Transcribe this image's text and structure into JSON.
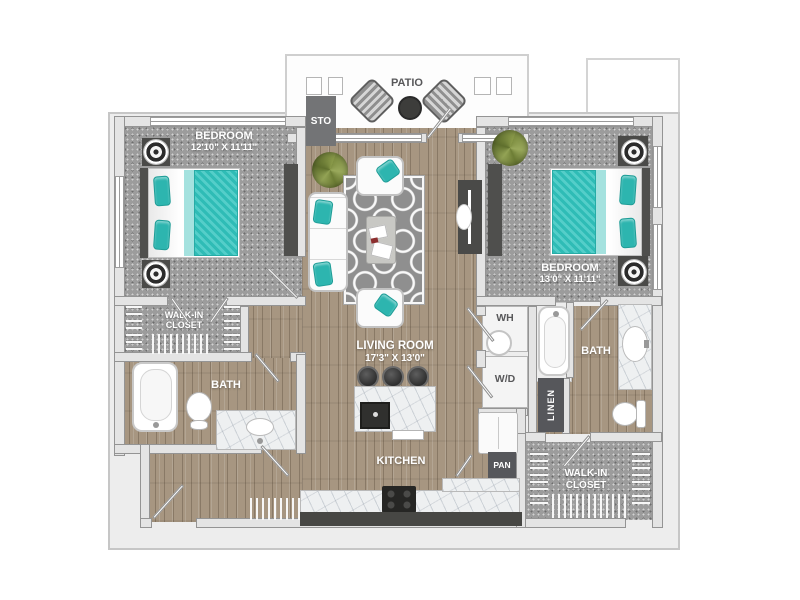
{
  "palette": {
    "teal": "#3fc4be",
    "wood": "#a79681",
    "carpet": "#9c9c9c",
    "wall": "#e4e4e4",
    "dark_furniture": "#4a4a48",
    "dark_box": "#56575b",
    "label_gray": "#58585a",
    "marble": "#eef0f1",
    "plant_green": "#8a9a4a"
  },
  "rooms": {
    "bedroom_left": {
      "label": "BEDROOM",
      "dims": "12'10\" X 11'11\""
    },
    "bedroom_right": {
      "label": "BEDROOM",
      "dims": "13'0\" X 11'11\""
    },
    "living_room": {
      "label": "LIVING ROOM",
      "dims": "17'3\" X 13'0\""
    },
    "kitchen": {
      "label": "KITCHEN"
    },
    "patio": {
      "label": "PATIO"
    },
    "bath_left": {
      "label": "BATH"
    },
    "bath_right": {
      "label": "BATH"
    },
    "walk_in_closet_left": {
      "line1": "WALK-IN",
      "line2": "CLOSET"
    },
    "walk_in_closet_right": {
      "line1": "WALK-IN",
      "line2": "CLOSET"
    }
  },
  "utilities": {
    "storage": {
      "label": "STO"
    },
    "water_heater": {
      "label": "WH"
    },
    "washer_dryer": {
      "label": "W/D"
    },
    "linen": {
      "label": "LINEN"
    },
    "pantry": {
      "label": "PAN"
    }
  }
}
